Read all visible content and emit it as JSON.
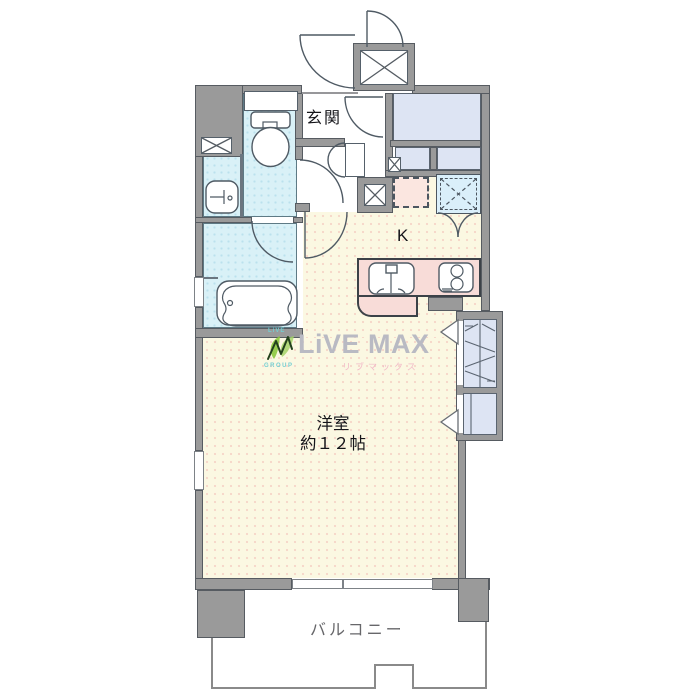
{
  "plan": {
    "labels": {
      "genkan": "玄関",
      "kitchen": "K",
      "room_name": "洋室",
      "room_size": "約１２帖",
      "balcony": "バルコニー"
    },
    "watermark": {
      "brand_top": "LiVE",
      "brand_main": "LiVE MAX",
      "brand_group": "GROUP",
      "brand_kana": "リブマックス"
    },
    "fixtures": [
      "toilet-icon",
      "washbasin-icon",
      "bathtub-icon",
      "kitchen-sink-icon",
      "stove-icon",
      "washer-space",
      "refrigerator-space",
      "pipe-shaft",
      "elevator-shaft",
      "closet-hatch",
      "entry-door-arc",
      "balcony-hatch"
    ],
    "colors": {
      "wall": "#9a9a9a",
      "wall-edge": "#565b61",
      "line": "#55606a",
      "floor-yellow": "#fbf8e2",
      "floor-cyan": "#d9f1f7",
      "floor-lavender": "#dde4f3",
      "counter-pink": "#f8dcd8",
      "fridge-pink": "#fbe6e0",
      "washer-cyan": "#daeffa",
      "balcony-label": "#67676a",
      "label-ink": "#15151a",
      "logo-gray": "#b9bac3",
      "logo-green": "#8cc63f",
      "logo-teal": "#74ced2",
      "logo-pink": "#f2bac8"
    }
  }
}
